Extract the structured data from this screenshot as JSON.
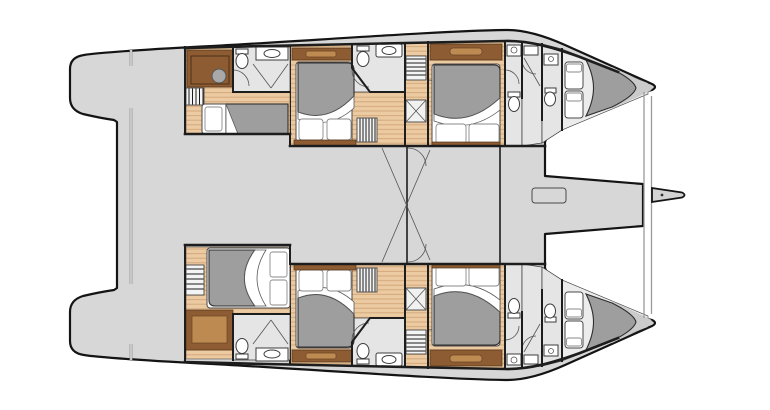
{
  "meta": {
    "title": "Catamaran yacht cabin deck floor plan",
    "view": "top-down naval architecture plan",
    "orientation": "bow to the right, stern to the left"
  },
  "colors": {
    "background": "#ffffff",
    "deck": "#d7d7d7",
    "outline": "#141414",
    "wall": "#1d1d1d",
    "wood_floor": "#eccaa2",
    "wood_plank_line": "#d2a97c",
    "furniture_brown": "#8d5c33",
    "furniture_brown_light": "#bd8a52",
    "bathroom_floor": "#e5e5e5",
    "fixture_fill": "#ffffff",
    "fixture_stroke": "#3c3c3c",
    "duvet_gray": "#9e9e9e",
    "mattress_white": "#ffffff",
    "bow_tip_gray": "#cbcbcb",
    "hatch_line": "#1c1c1c",
    "seam_gray": "#8f8f8f",
    "thin_line": "#555555"
  },
  "regions": [
    "aft-port-crew-cabin",
    "aft-starboard-owner-cabin",
    "midship-port-double-cabin",
    "midship-starboard-double-cabin",
    "forward-port-double-cabin",
    "forward-starboard-double-cabin",
    "port-bow-vberth-cabin",
    "starboard-bow-vberth-cabin",
    "ensuite-bathrooms",
    "central-saloon-bridgedeck",
    "aft-cockpit",
    "foredeck-walkway",
    "trampoline",
    "bowsprit"
  ],
  "fixtures": [
    "double-bed",
    "single-berth",
    "pillow",
    "duvet",
    "toilet",
    "sink",
    "shower",
    "companionway-stairs",
    "wardrobe",
    "desk",
    "desk-chair",
    "louver-vent",
    "deck-hatch",
    "skylight",
    "davit-track",
    "forward-crossbeam"
  ]
}
